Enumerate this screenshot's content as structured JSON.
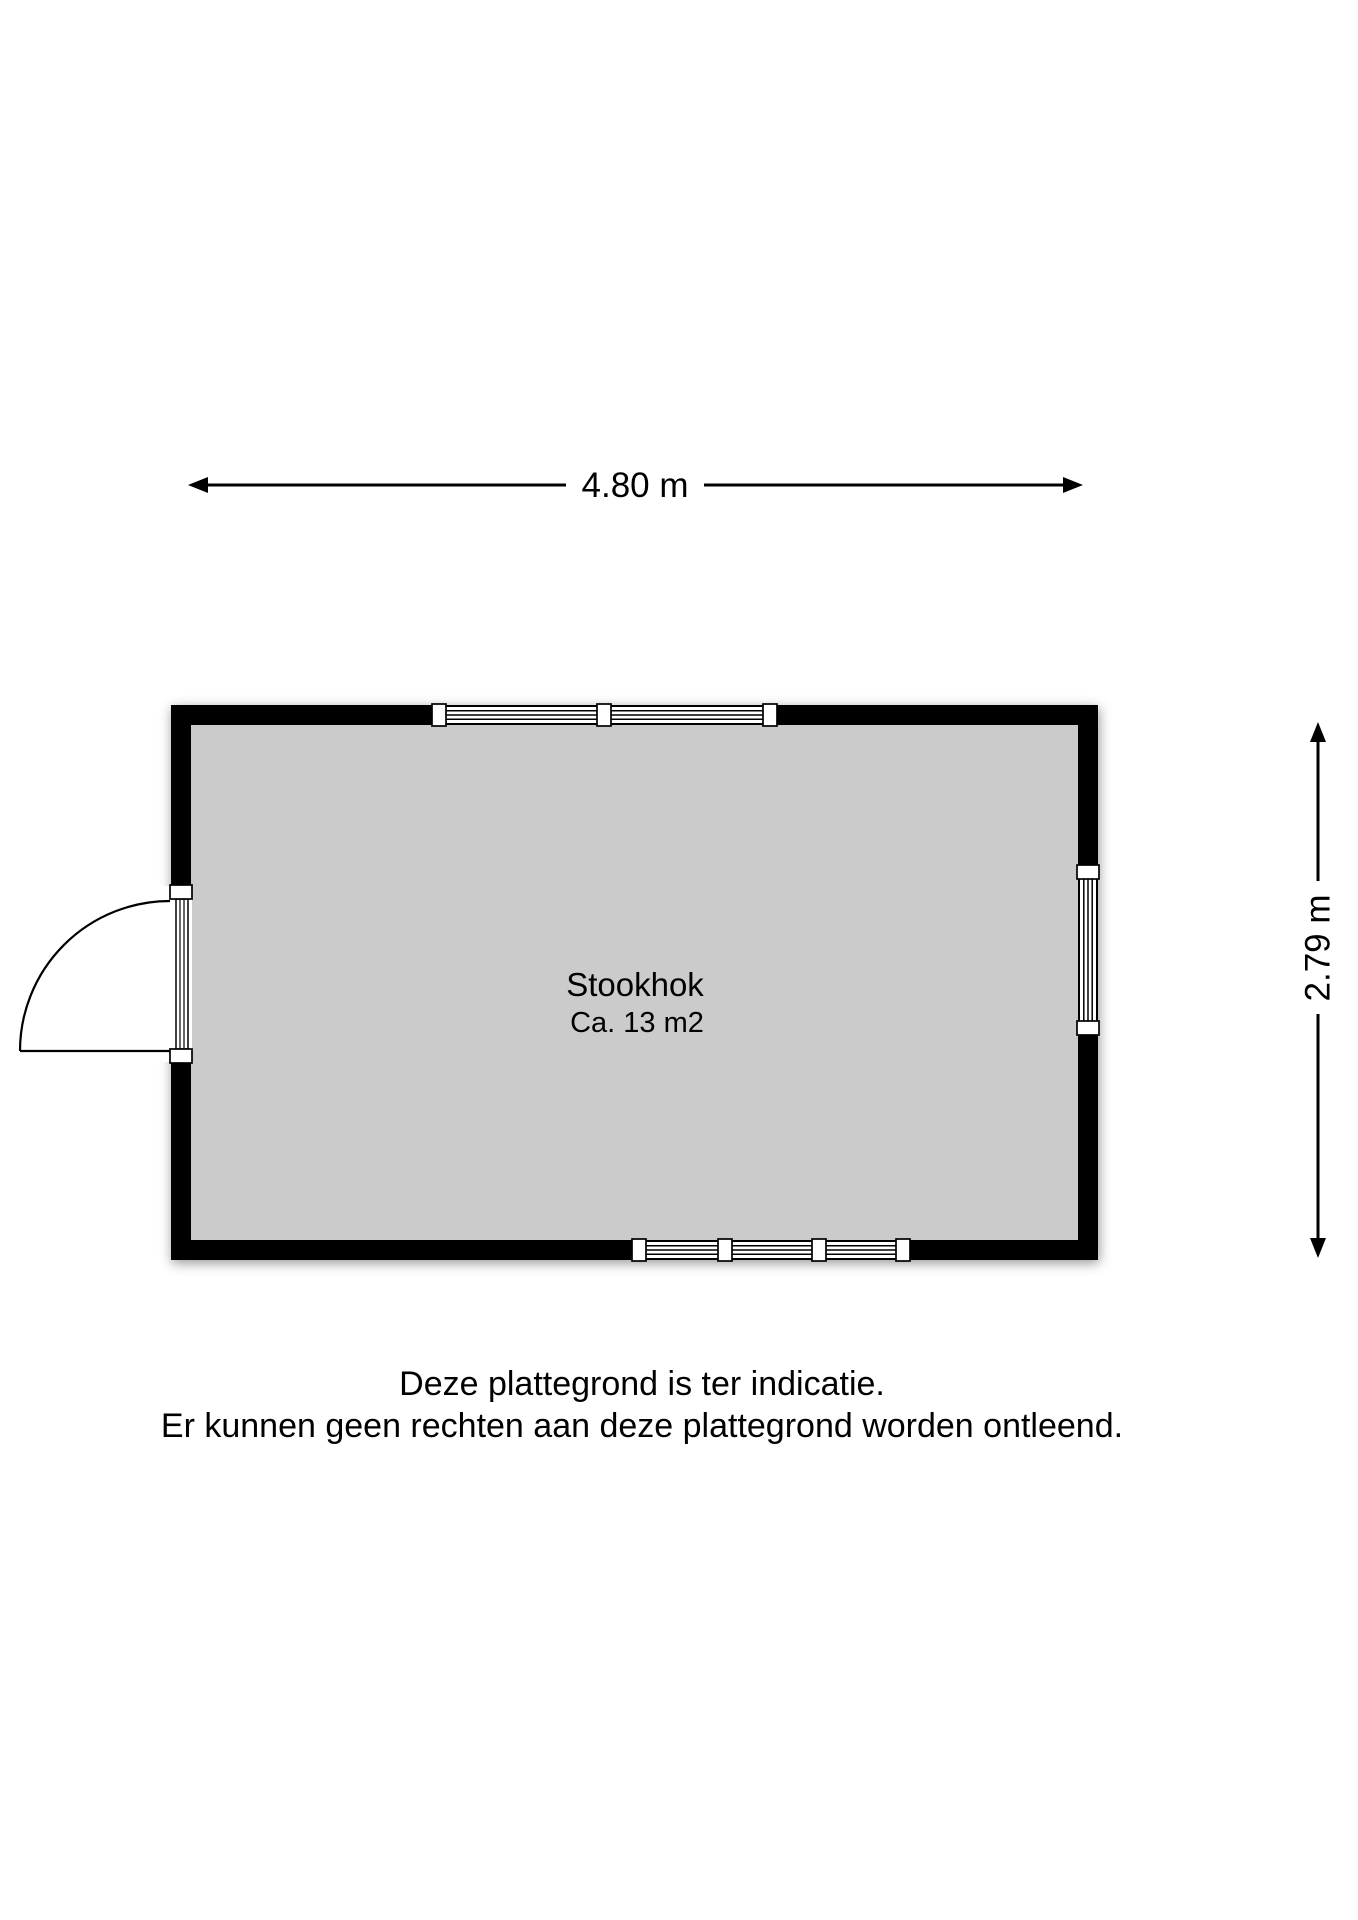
{
  "dimensions": {
    "width_label": "4.80 m",
    "height_label": "2.79 m"
  },
  "room": {
    "name": "Stookhok",
    "area": "Ca. 13 m2"
  },
  "disclaimer": {
    "line1": "Deze plattegrond is ter indicatie.",
    "line2": "Er kunnen geen rechten aan deze plattegrond worden ontleend."
  },
  "colors": {
    "wall": "#000000",
    "floor": "#cbcbcb",
    "background": "#ffffff",
    "line": "#000000"
  }
}
